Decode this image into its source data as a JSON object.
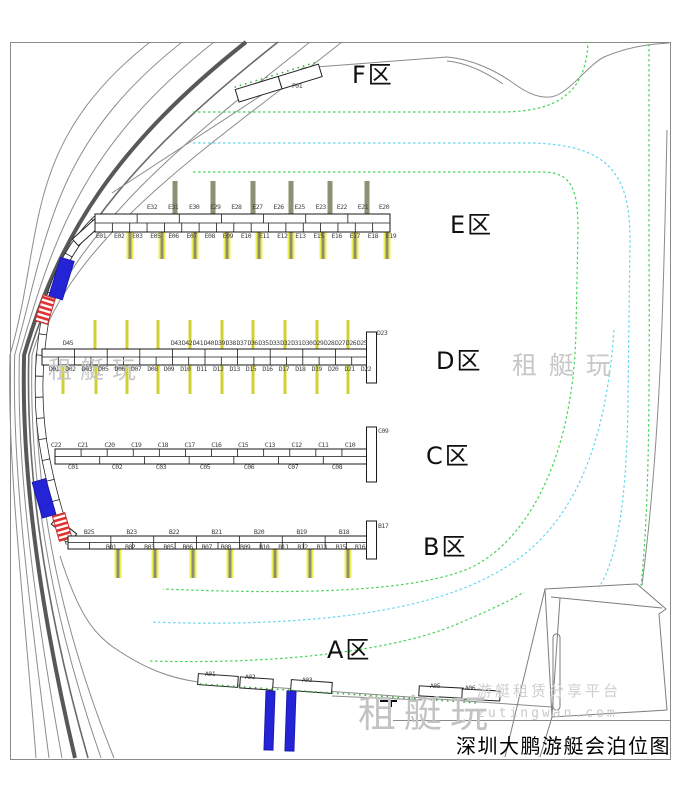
{
  "title": "深圳大鹏游艇会泊位图",
  "watermark": {
    "brand": "租艇玩",
    "domain": "zutingwan.com",
    "tagline": "游艇租赁分享平台"
  },
  "zones": [
    {
      "id": "F",
      "label": "F区",
      "berths": [
        "F01"
      ]
    },
    {
      "id": "E",
      "label": "E区",
      "top_berths": [
        "E32",
        "E31",
        "E30",
        "E29",
        "E28",
        "E27",
        "E26",
        "E25",
        "E23",
        "E22",
        "E21",
        "E20"
      ],
      "bottom_berths": [
        "E01",
        "E02",
        "E03",
        "E05",
        "E06",
        "E07",
        "E08",
        "E09",
        "E10",
        "E11",
        "E12",
        "E13",
        "E15",
        "E16",
        "E17",
        "E18",
        "E19"
      ]
    },
    {
      "id": "D",
      "label": "D区",
      "end_berth": "D23",
      "top_berths": [
        "D45",
        "D43",
        "D42",
        "D41",
        "D40",
        "D39",
        "D38",
        "D37",
        "D36",
        "D35",
        "D33",
        "D32",
        "D31",
        "D30",
        "D29",
        "D28",
        "D27",
        "D26",
        "D25"
      ],
      "bottom_berths": [
        "D01",
        "D02",
        "D03",
        "D05",
        "D06",
        "D07",
        "D08",
        "D09",
        "D10",
        "D11",
        "D12",
        "D13",
        "D15",
        "D16",
        "D17",
        "D18",
        "D19",
        "D20",
        "D21",
        "D22"
      ]
    },
    {
      "id": "C",
      "label": "C区",
      "end_berth": "C09",
      "top_berths": [
        "C22",
        "C21",
        "C20",
        "C19",
        "C18",
        "C17",
        "C16",
        "C15",
        "C13",
        "C12",
        "C11",
        "C10"
      ],
      "bottom_berths": [
        "C01",
        "C02",
        "C03",
        "C05",
        "C06",
        "C07",
        "C08"
      ]
    },
    {
      "id": "B",
      "label": "B区",
      "end_berth": "B17",
      "top_berths": [
        "B25",
        "B23",
        "B22",
        "B21",
        "B20",
        "B19",
        "B18"
      ],
      "bottom_berths": [
        "B01",
        "B02",
        "B03",
        "B05",
        "B06",
        "B07",
        "B08",
        "B09",
        "B10",
        "B11",
        "B12",
        "B13",
        "B15",
        "B16"
      ]
    },
    {
      "id": "A",
      "label": "A区",
      "berths": [
        "A01",
        "A02",
        "A03",
        "A05",
        "A06"
      ]
    }
  ],
  "colors": {
    "dock_outline": "#1a1a1a",
    "finger_yellow": "#efef52",
    "finger_thin_yellow": "#d0d033",
    "pile_gray": "#8f8f73",
    "boat_blue": "#2424d6",
    "boat_red": "#e03030",
    "boundary_green": "#44d455",
    "boundary_cyan": "#5fd8ee",
    "shore_gray": "#8a8a8a",
    "watermark_gray": "#c7c7c7"
  }
}
